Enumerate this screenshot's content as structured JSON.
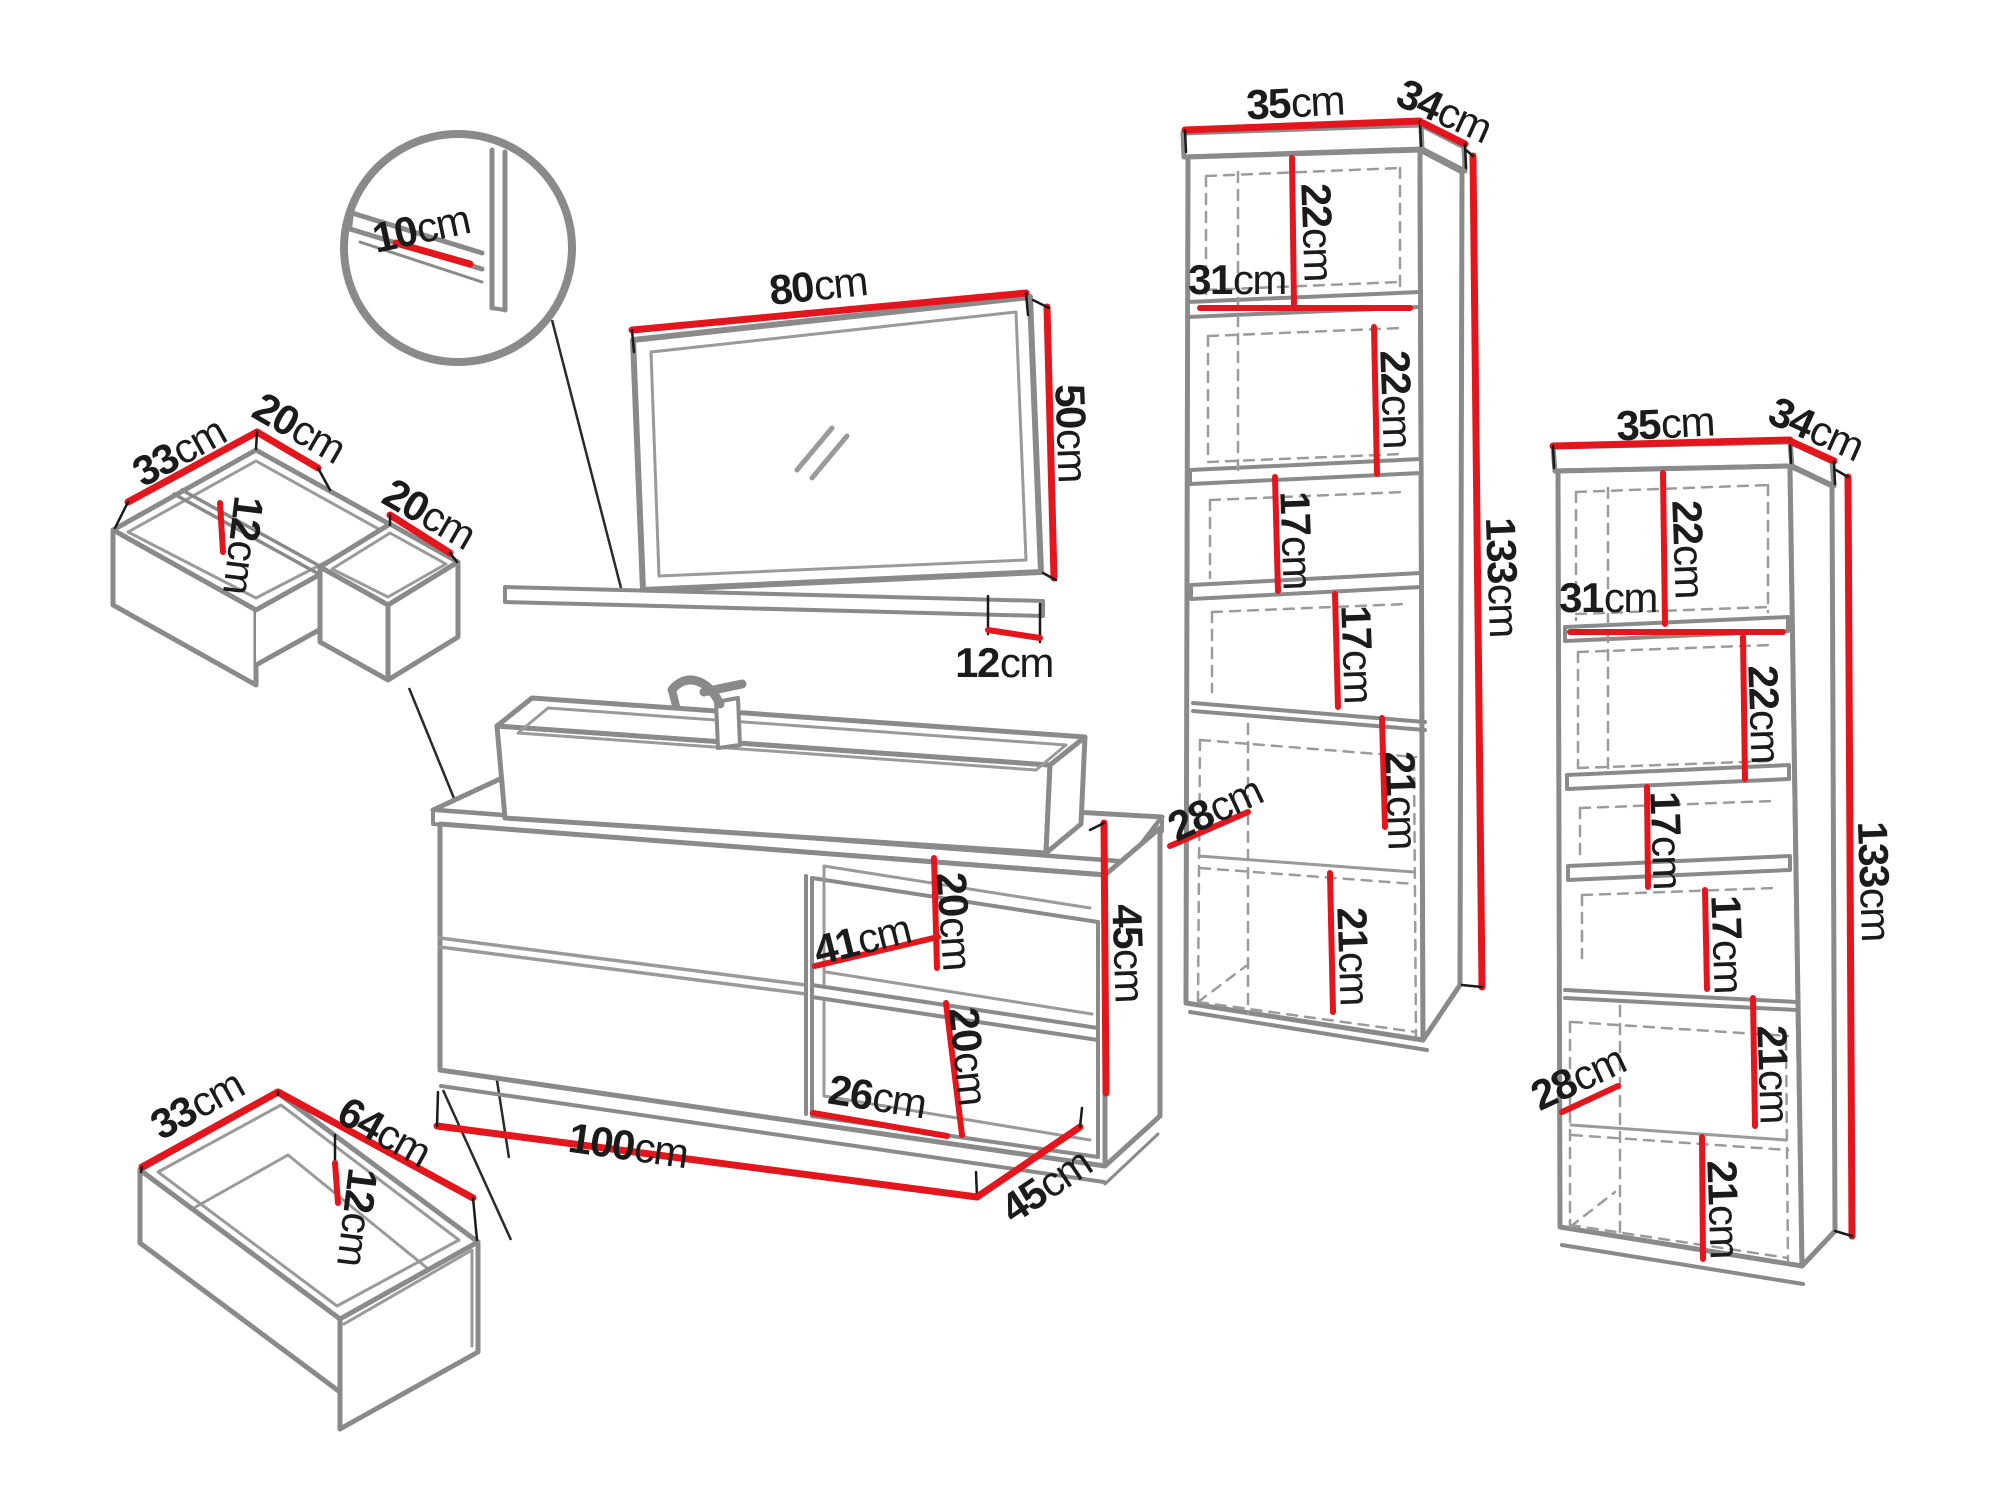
{
  "unit": "cm",
  "colors": {
    "dimension_red": "#e2161c",
    "outline_gray": "#8a8a8a",
    "label_black": "#1b1b1b",
    "background": "#ffffff"
  },
  "pieces": {
    "mirror_detail": {
      "shelf_thickness": "10"
    },
    "mirror": {
      "width": "80",
      "height": "50",
      "shelf_depth": "12"
    },
    "drawer_organizer": {
      "side": "33",
      "front_section": "20",
      "depth": "12",
      "side_section": "20"
    },
    "bottom_drawer": {
      "side": "33",
      "front": "64",
      "depth": "12"
    },
    "vanity": {
      "niche_width": "41",
      "niche_upper_height": "20",
      "niche_lower_width": "26",
      "niche_lower_height": "20",
      "width": "100",
      "depth": "45",
      "height": "45"
    },
    "tall_cabinet_left": {
      "top_width": "35",
      "top_depth": "34",
      "upper_niche_height": "22",
      "inner_width": "31",
      "second_niche_height": "22",
      "third_niche_height": "17",
      "fourth_niche_height": "17",
      "door_upper_height": "21",
      "inner_depth": "28",
      "door_lower_height": "21",
      "height": "133"
    },
    "tall_cabinet_right": {
      "top_width": "35",
      "top_depth": "34",
      "upper_niche_height": "22",
      "inner_width": "31",
      "second_niche_height": "22",
      "third_niche_height": "17",
      "fourth_niche_height": "17",
      "door_upper_height": "21",
      "inner_depth": "28",
      "door_lower_height": "21",
      "height": "133"
    }
  }
}
